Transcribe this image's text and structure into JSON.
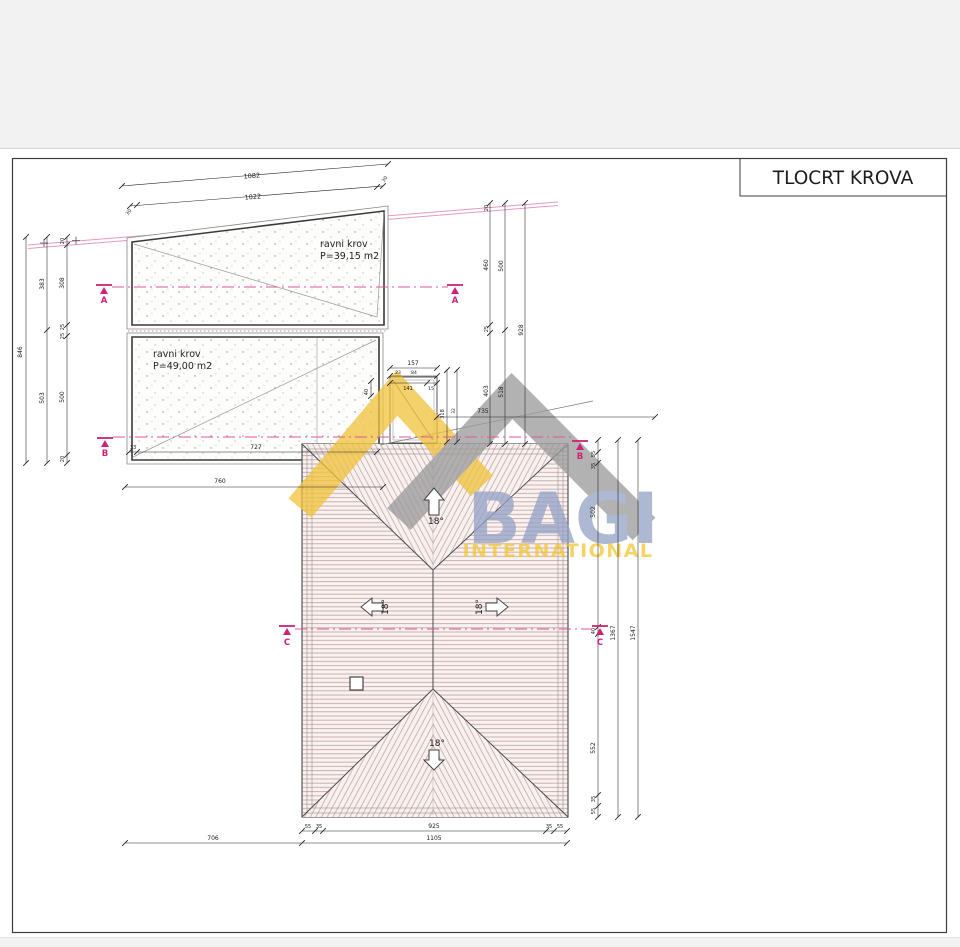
{
  "title": "TLOCRT KROVA",
  "roof1": {
    "name": "ravni krov",
    "area": "P=39,15 m2"
  },
  "roof2": {
    "name": "ravni krov",
    "area": "P=49,00 m2"
  },
  "slopes": {
    "top": "18°",
    "left": "18°",
    "right": "18°",
    "bottom": "18°"
  },
  "sections": {
    "a": "A",
    "b": "B",
    "c": "C"
  },
  "watermark": {
    "name": "BAGI",
    "subtitle": "INTERNATIONAL"
  },
  "colors": {
    "section_pink": "#cc2277",
    "boundary_pink": "#e39ac2",
    "hatch_pink": "#c9a7a7",
    "watermark_yellow": "#f1c33d",
    "watermark_gray": "#9a9a9a",
    "watermark_blue": "#94a2c6"
  },
  "dims": [
    {
      "v": "1082",
      "x": 252,
      "y": 178,
      "r": -4.5,
      "s": 6.5
    },
    {
      "v": "1022",
      "x": 253,
      "y": 199,
      "r": -4.5,
      "s": 6.5
    },
    {
      "v": "30",
      "x": 386,
      "y": 180,
      "r": -55,
      "s": 5
    },
    {
      "v": "30",
      "x": 130,
      "y": 213,
      "r": -55,
      "s": 5
    },
    {
      "v": "846",
      "x": 22,
      "y": 352,
      "r": -90,
      "s": 6
    },
    {
      "v": "383",
      "x": 44,
      "y": 284,
      "r": -90,
      "s": 6
    },
    {
      "v": "503",
      "x": 44,
      "y": 398,
      "r": -90,
      "s": 6
    },
    {
      "v": "20",
      "x": 64,
      "y": 241,
      "r": -90,
      "s": 5
    },
    {
      "v": "308",
      "x": 64,
      "y": 283,
      "r": -90,
      "s": 6
    },
    {
      "v": "25",
      "x": 64,
      "y": 327,
      "r": -90,
      "s": 5
    },
    {
      "v": "25",
      "x": 64,
      "y": 336,
      "r": -90,
      "s": 5
    },
    {
      "v": "500",
      "x": 64,
      "y": 397,
      "r": -90,
      "s": 6
    },
    {
      "v": "20",
      "x": 64,
      "y": 459,
      "r": -90,
      "s": 5
    },
    {
      "v": "20",
      "x": 488,
      "y": 208,
      "r": -90,
      "s": 5
    },
    {
      "v": "460",
      "x": 488,
      "y": 265,
      "r": -90,
      "s": 6
    },
    {
      "v": "25",
      "x": 488,
      "y": 329,
      "r": -90,
      "s": 5
    },
    {
      "v": "403",
      "x": 488,
      "y": 391,
      "r": -90,
      "s": 6
    },
    {
      "v": "500",
      "x": 503,
      "y": 266,
      "r": -90,
      "s": 6
    },
    {
      "v": "518",
      "x": 503,
      "y": 392,
      "r": -90,
      "s": 6
    },
    {
      "v": "928",
      "x": 523,
      "y": 330,
      "r": -90,
      "s": 6
    },
    {
      "v": "157",
      "x": 413,
      "y": 365,
      "r": 0,
      "s": 6
    },
    {
      "v": "23",
      "x": 398,
      "y": 374,
      "r": 0,
      "s": 4.5
    },
    {
      "v": "84",
      "x": 414,
      "y": 374,
      "r": 0,
      "s": 4.5
    },
    {
      "v": "141",
      "x": 408,
      "y": 390,
      "r": 0,
      "s": 5
    },
    {
      "v": "15",
      "x": 431,
      "y": 390,
      "r": 0,
      "s": 4.5
    },
    {
      "v": "40",
      "x": 368,
      "y": 392,
      "r": -90,
      "s": 5
    },
    {
      "v": "318",
      "x": 444,
      "y": 414,
      "r": -90,
      "s": 5
    },
    {
      "v": "32",
      "x": 455,
      "y": 411,
      "r": -90,
      "s": 4.5
    },
    {
      "v": "735",
      "x": 483,
      "y": 413,
      "r": 0,
      "s": 6
    },
    {
      "v": "33",
      "x": 133,
      "y": 449,
      "r": 0,
      "s": 5
    },
    {
      "v": "727",
      "x": 256,
      "y": 449,
      "r": 0,
      "s": 6
    },
    {
      "v": "760",
      "x": 220,
      "y": 483,
      "r": 0,
      "s": 6
    },
    {
      "v": "55",
      "x": 595,
      "y": 454,
      "r": -90,
      "s": 5
    },
    {
      "v": "35",
      "x": 595,
      "y": 466,
      "r": -90,
      "s": 5
    },
    {
      "v": "502",
      "x": 595,
      "y": 512,
      "r": -90,
      "s": 6
    },
    {
      "v": "40",
      "x": 595,
      "y": 631,
      "r": -90,
      "s": 5
    },
    {
      "v": "552",
      "x": 595,
      "y": 748,
      "r": -90,
      "s": 6
    },
    {
      "v": "35",
      "x": 595,
      "y": 799,
      "r": -90,
      "s": 5
    },
    {
      "v": "55",
      "x": 595,
      "y": 811,
      "r": -90,
      "s": 5
    },
    {
      "v": "1367",
      "x": 615,
      "y": 633,
      "r": -90,
      "s": 6
    },
    {
      "v": "1547",
      "x": 635,
      "y": 633,
      "r": -90,
      "s": 6
    },
    {
      "v": "55",
      "x": 308,
      "y": 828,
      "r": 0,
      "s": 5
    },
    {
      "v": "35",
      "x": 319,
      "y": 828,
      "r": 0,
      "s": 5
    },
    {
      "v": "925",
      "x": 434,
      "y": 828,
      "r": 0,
      "s": 6
    },
    {
      "v": "35",
      "x": 549,
      "y": 828,
      "r": 0,
      "s": 5
    },
    {
      "v": "55",
      "x": 560,
      "y": 828,
      "r": 0,
      "s": 5
    },
    {
      "v": "706",
      "x": 213,
      "y": 840,
      "r": 0,
      "s": 6
    },
    {
      "v": "1105",
      "x": 434,
      "y": 840,
      "r": 0,
      "s": 6
    }
  ]
}
